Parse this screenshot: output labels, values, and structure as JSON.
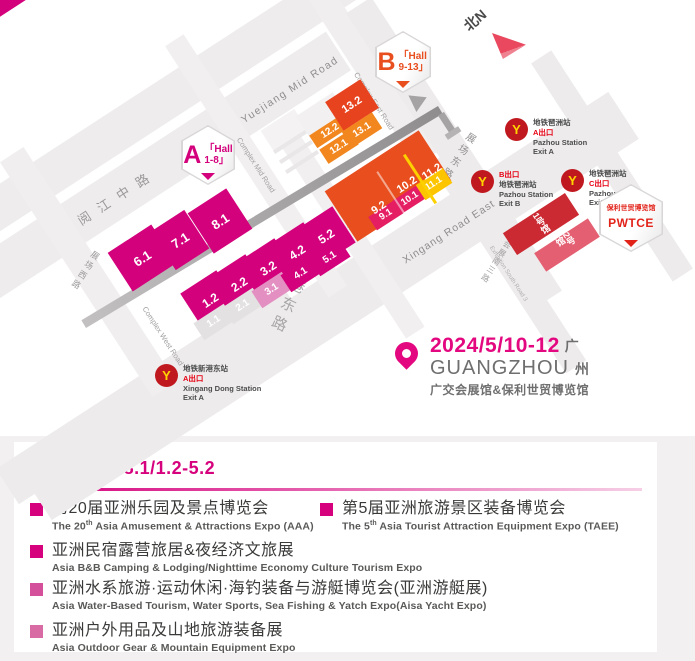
{
  "map": {
    "compass": {
      "label": "北N"
    },
    "badges": {
      "a": {
        "letter": "A",
        "line1": "「Hall",
        "line2": "1-8」",
        "color": "#d4017c"
      },
      "b": {
        "letter": "B",
        "line1": "「Hall",
        "line2": "9-13」",
        "color": "#e84e1e"
      },
      "pwtce": {
        "line1": "保利世贸博览馆",
        "line2": "PWTCE",
        "color": "#e2231a"
      }
    },
    "event": {
      "date": "2024/5/10-12",
      "city_cn_1": "广",
      "city_en": "GUANGZHOU",
      "city_cn_2": "州",
      "venues": "广交会展馆&保利世贸博览馆",
      "accent": "#e40880"
    },
    "roads": [
      {
        "n": "road-band",
        "x": 230,
        "y": 58,
        "w": 720,
        "h": 40,
        "rot": -33,
        "c": "#eeecec",
        "z": 1
      },
      {
        "n": "road-band",
        "x": 112,
        "y": 198,
        "w": 540,
        "h": 46,
        "rot": -33,
        "c": "#eeecec",
        "z": 1
      },
      {
        "n": "road-band",
        "x": 330,
        "y": 306,
        "w": 700,
        "h": 56,
        "rot": -33,
        "c": "#edebeb",
        "z": 1
      },
      {
        "n": "road-band",
        "x": 150,
        "y": 394,
        "w": 340,
        "h": 42,
        "rot": -33,
        "c": "#edebeb",
        "z": 1
      },
      {
        "n": "road-band",
        "x": 362,
        "y": 58,
        "w": 240,
        "h": 26,
        "rot": 57,
        "c": "#f0eeee",
        "z": 1
      },
      {
        "n": "road-band",
        "x": 256,
        "y": 166,
        "w": 300,
        "h": 22,
        "rot": 57,
        "c": "#f1efef",
        "z": 1
      },
      {
        "n": "road-band",
        "x": 88,
        "y": 272,
        "w": 280,
        "h": 28,
        "rot": 57,
        "c": "#f0eeee",
        "z": 1
      },
      {
        "n": "road-band",
        "x": 350,
        "y": 232,
        "w": 240,
        "h": 22,
        "rot": 57,
        "c": "#f1efef",
        "z": 1
      },
      {
        "n": "road-band",
        "x": 454,
        "y": 152,
        "w": 350,
        "h": 30,
        "rot": 57,
        "c": "#edebeb",
        "z": 1
      },
      {
        "n": "road-band",
        "x": 508,
        "y": 262,
        "w": 250,
        "h": 24,
        "rot": 57,
        "c": "#edebeb",
        "z": 1
      },
      {
        "n": "road-band",
        "x": 612,
        "y": 166,
        "w": 260,
        "h": 24,
        "rot": 57,
        "c": "#edebeb",
        "z": 1
      },
      {
        "n": "building",
        "x": 284,
        "y": 130,
        "w": 40,
        "h": 24,
        "rot": -33,
        "c": "#f4f2f2",
        "z": 2
      },
      {
        "n": "building",
        "x": 322,
        "y": 116,
        "w": 44,
        "h": 28,
        "rot": -33,
        "c": "#f2f0f0",
        "z": 2
      },
      {
        "n": "building",
        "x": 290,
        "y": 142,
        "w": 38,
        "h": 4,
        "rot": -33,
        "c": "#e9e7e7",
        "z": 2
      },
      {
        "n": "building",
        "x": 296,
        "y": 152,
        "w": 38,
        "h": 4,
        "rot": -33,
        "c": "#e9e7e7",
        "z": 2
      },
      {
        "n": "building",
        "x": 302,
        "y": 162,
        "w": 38,
        "h": 4,
        "rot": -33,
        "c": "#e9e7e7",
        "z": 2
      },
      {
        "n": "corner-block",
        "x": 8,
        "y": 2,
        "w": 56,
        "h": 16,
        "rot": -33,
        "c": "#d4017c",
        "z": 2
      },
      {
        "n": "elevated-walkway",
        "x": 262,
        "y": 217,
        "w": 416,
        "h": 9,
        "rot": -31,
        "c": "linear-gradient(90deg,#c2c0c0,#8f8d8d)",
        "z": 3
      },
      {
        "n": "walkway-leg",
        "x": 447,
        "y": 123,
        "w": 22,
        "h": 7,
        "rot": 57,
        "c": "#a5a3a3",
        "z": 3
      },
      {
        "n": "walkway-foot",
        "x": 453,
        "y": 133,
        "w": 16,
        "h": 6,
        "rot": -33,
        "c": "#b5b3b3",
        "z": 3
      },
      {
        "n": "hall-divider-yellow",
        "x": 420,
        "y": 179,
        "w": 3,
        "h": 58,
        "rot": -33,
        "c": "#fdd000",
        "z": 5
      },
      {
        "n": "hall-divider-white",
        "x": 393,
        "y": 196,
        "w": 2,
        "h": 58,
        "rot": -33,
        "c": "rgba(255,255,255,0.5)",
        "z": 5
      }
    ],
    "labels": [
      {
        "t": "Yuejiang Mid Road",
        "x": 290,
        "y": 90,
        "rot": -33,
        "fs": 10.5,
        "ls": 1.5,
        "c": "#8f8d8d"
      },
      {
        "t": "阅江中路",
        "x": 117,
        "y": 196,
        "rot": -33,
        "fs": 13,
        "ls": 10,
        "c": "#9b9999"
      },
      {
        "t": "Complex Mid Road",
        "x": 256,
        "y": 165,
        "rot": 57,
        "fs": 7.5,
        "ls": 0,
        "c": "#a3a1a1"
      },
      {
        "t": "Complex East Road",
        "x": 374,
        "y": 101,
        "rot": 57,
        "fs": 7.5,
        "ls": 0,
        "c": "#a3a1a1"
      },
      {
        "t": "Complex West Road",
        "x": 163,
        "y": 336,
        "rot": 57,
        "fs": 7.5,
        "ls": 0,
        "c": "#a3a1a1"
      },
      {
        "t": "展场西路",
        "x": 85,
        "y": 271,
        "rot": 33,
        "fs": 8.5,
        "ls": 3,
        "c": "#9b9999",
        "vert": true
      },
      {
        "t": "展场中路",
        "x": 348,
        "y": 233,
        "rot": 33,
        "fs": 8.5,
        "ls": 3,
        "c": "#9b9999",
        "vert": true
      },
      {
        "t": "展场东路",
        "x": 457,
        "y": 156,
        "rot": 33,
        "fs": 10,
        "ls": 4,
        "c": "#949292",
        "vert": true
      },
      {
        "t": "新港东路",
        "x": 291,
        "y": 297,
        "rot": 25,
        "fs": 15,
        "ls": 6,
        "c": "#a7a5a5",
        "vert": true
      },
      {
        "t": "Xingang  Road  East",
        "x": 449,
        "y": 232,
        "rot": -33,
        "fs": 10.5,
        "ls": 1,
        "c": "#8f8d8d"
      },
      {
        "t": "会展南三路",
        "x": 496,
        "y": 262,
        "rot": 33,
        "fs": 8,
        "ls": 2,
        "c": "#a3a1a1",
        "vert": true
      },
      {
        "t": "Exhibition South Road 3",
        "x": 508,
        "y": 274,
        "rot": 57,
        "fs": 6,
        "ls": 0,
        "c": "#b2b0b0"
      }
    ],
    "halls": [
      {
        "t": "6.1",
        "x": 142,
        "y": 258,
        "w": 52,
        "h": 46,
        "bg": "#d4017c",
        "fs": 13
      },
      {
        "t": "7.1",
        "x": 180,
        "y": 240,
        "w": 40,
        "h": 46,
        "bg": "#d4017c",
        "fs": 13
      },
      {
        "t": "8.1",
        "x": 220,
        "y": 221,
        "w": 46,
        "h": 48,
        "bg": "#d4017c",
        "fs": 13
      },
      {
        "t": "1.2",
        "x": 210,
        "y": 300,
        "w": 43,
        "h": 43,
        "bg": "#d4017c",
        "fs": 12
      },
      {
        "t": "2.2",
        "x": 239,
        "y": 284,
        "w": 43,
        "h": 43,
        "bg": "#d4017c",
        "fs": 12
      },
      {
        "t": "3.2",
        "x": 268,
        "y": 268,
        "w": 43,
        "h": 43,
        "bg": "#d4017c",
        "fs": 12
      },
      {
        "t": "4.2",
        "x": 297,
        "y": 252,
        "w": 43,
        "h": 43,
        "bg": "#d4017c",
        "fs": 12
      },
      {
        "t": "5.2",
        "x": 326,
        "y": 236,
        "w": 43,
        "h": 43,
        "bg": "#d4017c",
        "fs": 12
      },
      {
        "t": "1.1",
        "x": 214,
        "y": 322,
        "w": 36,
        "h": 20,
        "bg": "#e3e1e1",
        "fs": 10
      },
      {
        "t": "2.1",
        "x": 243,
        "y": 306,
        "w": 36,
        "h": 20,
        "bg": "#e3e1e1",
        "fs": 10
      },
      {
        "t": "3.1",
        "x": 272,
        "y": 290,
        "w": 36,
        "h": 20,
        "bg": "#e38fc1",
        "fs": 10
      },
      {
        "t": "4.1",
        "x": 301,
        "y": 274,
        "w": 36,
        "h": 20,
        "bg": "#d4017c",
        "fs": 10
      },
      {
        "t": "5.1",
        "x": 330,
        "y": 258,
        "w": 36,
        "h": 20,
        "bg": "#d4017c",
        "fs": 10
      },
      {
        "t": "12.2",
        "x": 330,
        "y": 131,
        "w": 40,
        "h": 15,
        "bg": "#f2871f",
        "fs": 10
      },
      {
        "t": "12.1",
        "x": 339,
        "y": 147,
        "w": 36,
        "h": 17,
        "bg": "#f2871f",
        "fs": 10
      },
      {
        "t": "13.2",
        "x": 352,
        "y": 105,
        "w": 42,
        "h": 34,
        "bg": "#e8431f",
        "fs": 11
      },
      {
        "t": "13.1",
        "x": 362,
        "y": 130,
        "w": 36,
        "h": 19,
        "bg": "#f2871f",
        "fs": 10
      },
      {
        "t": "",
        "x": 388,
        "y": 186,
        "w": 112,
        "h": 60,
        "bg": "#e84e1e",
        "fs": 11
      },
      {
        "t": "9.1",
        "x": 386,
        "y": 215,
        "w": 32,
        "h": 16,
        "bg": "#e51e63",
        "fs": 9.5
      },
      {
        "t": "10.1",
        "x": 410,
        "y": 199,
        "w": 32,
        "h": 16,
        "bg": "#e51e63",
        "fs": 9.5
      },
      {
        "t": "11.1",
        "x": 434,
        "y": 184,
        "w": 32,
        "h": 18,
        "bg": "#fdc500",
        "fs": 9.5
      },
      {
        "t": "1号馆",
        "x": 541,
        "y": 224,
        "w": 74,
        "h": 26,
        "bg": "#cb2a33",
        "fs": 9,
        "vert": true
      },
      {
        "t": "2号馆",
        "x": 567,
        "y": 245,
        "w": 64,
        "h": 22,
        "bg": "#e45f71",
        "fs": 9,
        "vert": true
      }
    ],
    "hall_overlays": [
      {
        "t": "9.2",
        "x": 379,
        "y": 208,
        "fs": 11
      },
      {
        "t": "10.2",
        "x": 407,
        "y": 185,
        "fs": 11
      },
      {
        "t": "11.2",
        "x": 432,
        "y": 172,
        "fs": 11
      }
    ],
    "stations": [
      {
        "id": "pazhou-station-exit-a",
        "x": 505,
        "y": 118,
        "lines": [
          {
            "t": "地铁琶洲站"
          },
          {
            "t": "A出口",
            "red": true
          },
          {
            "t": "Pazhou Station"
          },
          {
            "t": "Exit A"
          }
        ]
      },
      {
        "id": "pazhou-station-exit-b",
        "x": 471,
        "y": 170,
        "lines": [
          {
            "t": "B出口",
            "red": true
          },
          {
            "t": "地铁琶洲站"
          },
          {
            "t": "Pazhou Station"
          },
          {
            "t": "Exit B"
          }
        ]
      },
      {
        "id": "pazhou-station-exit-c",
        "x": 561,
        "y": 169,
        "lines": [
          {
            "t": "地铁琶洲站"
          },
          {
            "t": "C出口",
            "red": true
          },
          {
            "t": "Pazhou Station"
          },
          {
            "t": "Exit C"
          }
        ]
      },
      {
        "id": "xingang-dong-station-exit-a",
        "x": 155,
        "y": 364,
        "lines": [
          {
            "t": "地铁新港东站"
          },
          {
            "t": "A出口",
            "red": true
          },
          {
            "t": "Xingang Dong Station"
          },
          {
            "t": "Exit A"
          }
        ]
      }
    ],
    "metro_letter": "Y"
  },
  "panel": {
    "zone_letter": "A",
    "zone_suffix": "区",
    "zone_range": "3.1-8.1/1.2-5.2",
    "accent": "#d6017d",
    "items": [
      {
        "cn": "第20届亚洲乐园及景点博览会",
        "en_pre": "The 20",
        "en_sup": "th",
        "en_post": " Asia Amusement & Attractions Expo (AAA)",
        "bullet": "#d6017d"
      },
      {
        "cn": "第5届亚洲旅游景区装备博览会",
        "en_pre": "The 5",
        "en_sup": "th",
        "en_post": " Asia Tourist Attraction Equipment Expo (TAEE)",
        "bullet": "#d6017d"
      },
      {
        "cn": "亚洲民宿露营旅居&夜经济文旅展",
        "en_pre": "Asia B&B Camping & Lodging/Nighttime Economy Culture Tourism Expo",
        "en_sup": "",
        "en_post": "",
        "bullet": "#d6017d"
      },
      {
        "cn": "亚洲水系旅游·运动休闲·海钓装备与游艇博览会(亚洲游艇展)",
        "en_pre": "Asia Water-Based Tourism, Water Sports, Sea Fishing & Yatch Expo(Aisa Yacht Expo)",
        "en_sup": "",
        "en_post": "",
        "bullet": "#d4509a"
      },
      {
        "cn": "亚洲户外用品及山地旅游装备展",
        "en_pre": "Asia Outdoor Gear & Mountain Equipment Expo",
        "en_sup": "",
        "en_post": "",
        "bullet": "#d86aa4"
      }
    ]
  }
}
